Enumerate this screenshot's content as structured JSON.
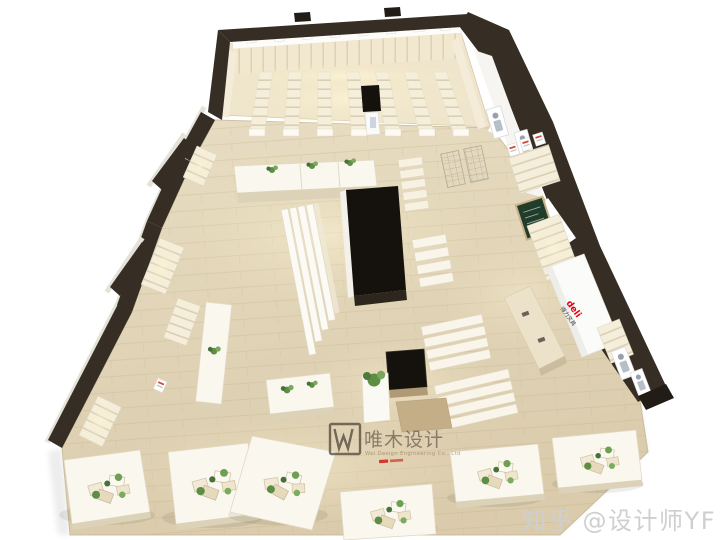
{
  "canvas": {
    "width": 720,
    "height": 540,
    "background": "#ffffff"
  },
  "watermark": {
    "title": "唯木设计",
    "subtitle": "Wei Design Engineering Co., Ltd",
    "color": "#4a4036"
  },
  "credit": {
    "text": "知乎 @设计师YF",
    "color": "#cfcfcf"
  },
  "brand": {
    "logo": "deli",
    "name": "得力文具",
    "color": "#e60012"
  },
  "colors": {
    "wall_dark": "#362e25",
    "wall_darker": "#211c15",
    "floor_light": "#e8ddc3",
    "floor_deep": "#d9cbaa",
    "shelf_cream": "#f4ecd8",
    "glow_warm": "#fff4d2",
    "black_fixture": "#15110c",
    "table_white": "#faf7ee",
    "plant_green": "#5d8e44",
    "board_green": "#223c2b",
    "wood_tan": "#c4ae88"
  }
}
